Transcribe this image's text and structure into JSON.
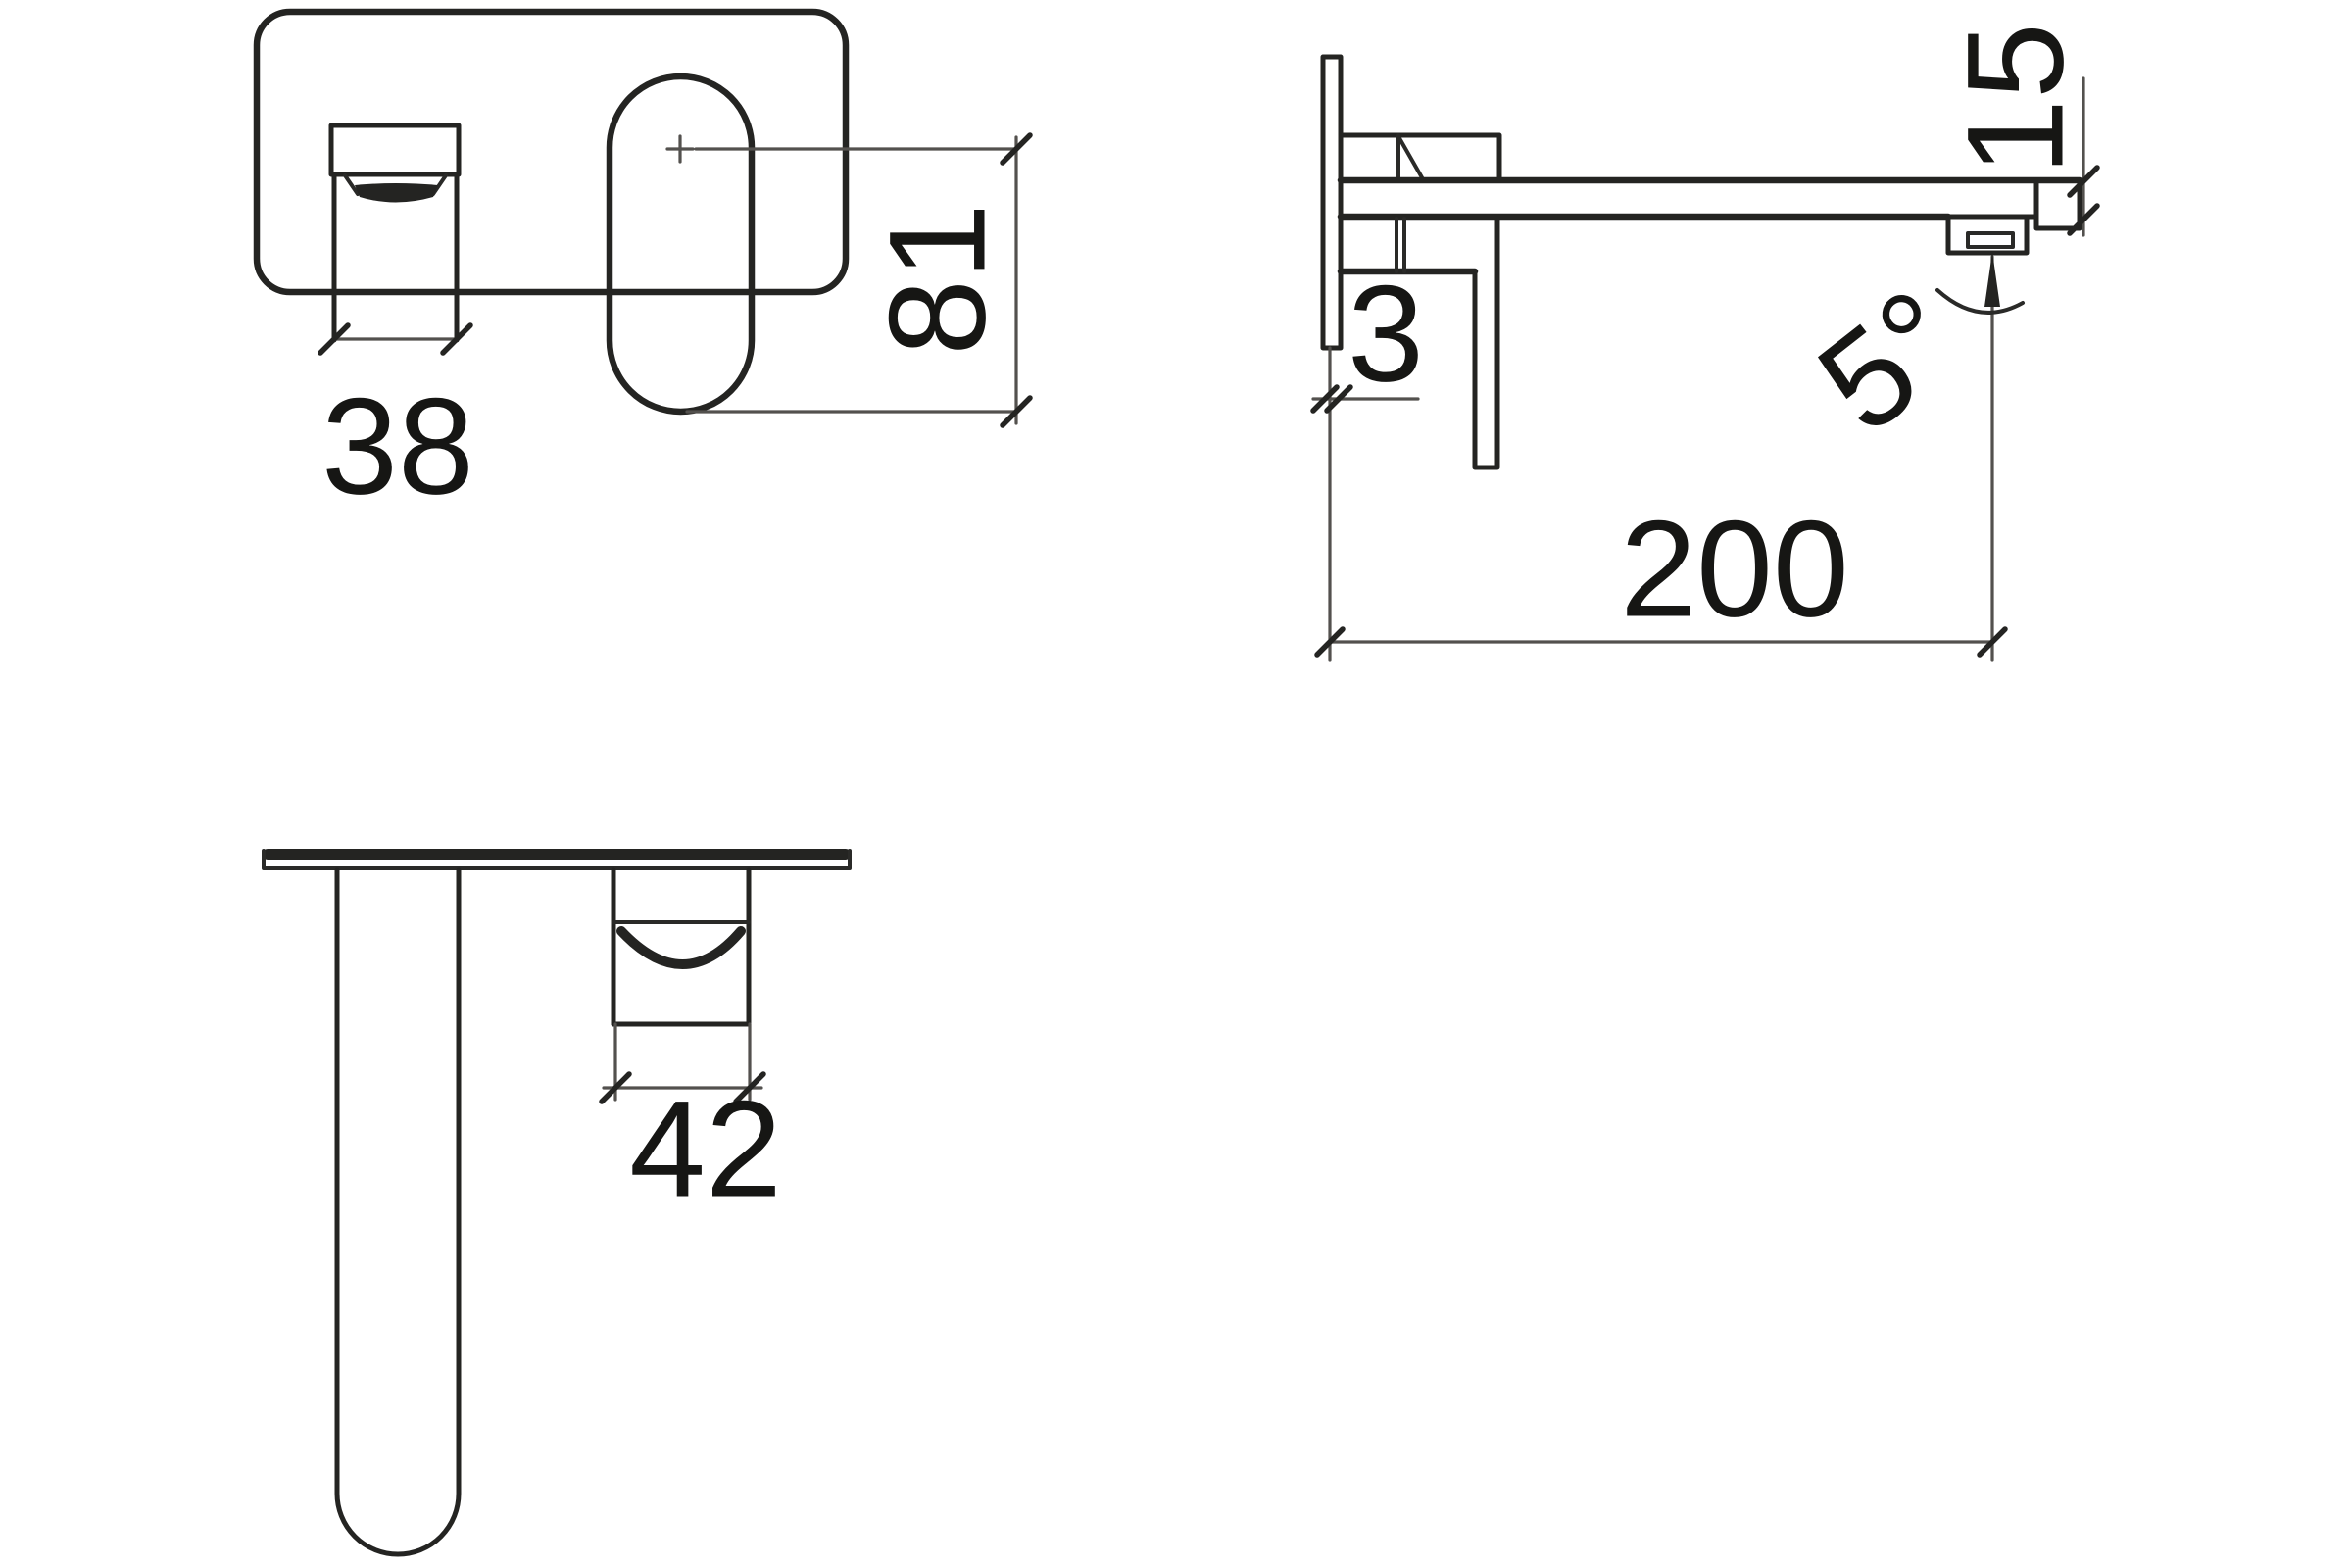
{
  "drawing": {
    "background_color": "#ffffff",
    "outline_color": "#242422",
    "dim_line_color": "#53514e",
    "text_color": "#161614",
    "dimensions": {
      "spout_width_front": "38",
      "mixer_height_front": "81",
      "plate_thickness_side": "3",
      "spout_reach_side": "200",
      "spout_end_height_side": "15",
      "spout_angle_side": "5°",
      "handle_width_bottom": "42"
    }
  }
}
